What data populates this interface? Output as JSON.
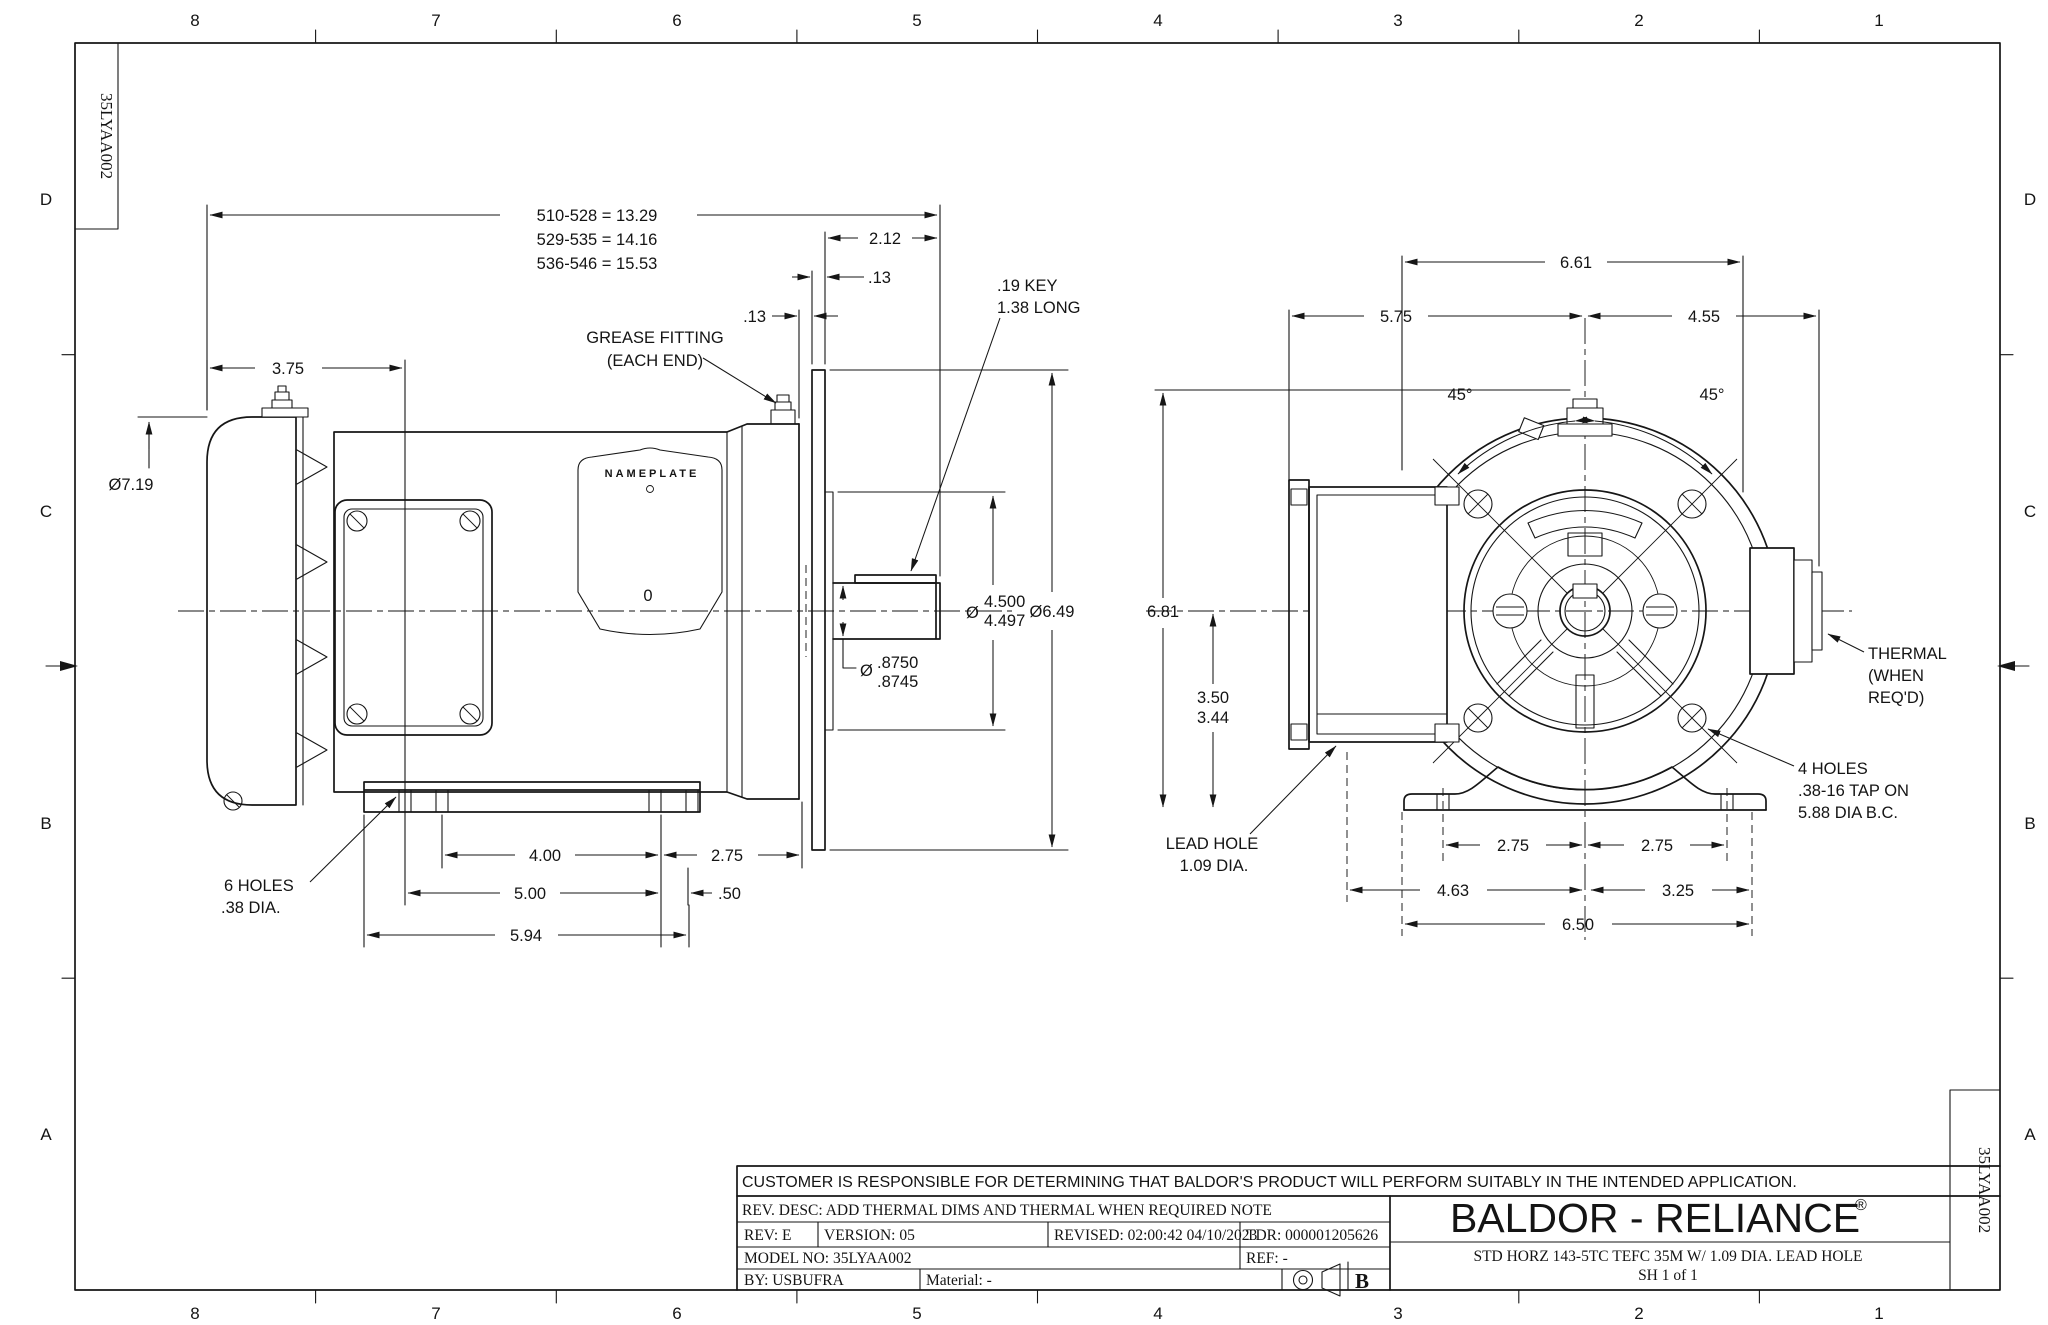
{
  "sheet": {
    "doc_number": "35LYAA002",
    "zone_cols": [
      "8",
      "7",
      "6",
      "5",
      "4",
      "3",
      "2",
      "1"
    ],
    "zone_rows": [
      "D",
      "C",
      "B",
      "A"
    ]
  },
  "side_view": {
    "overall_len_1": "510-528 = 13.29",
    "overall_len_2": "529-535 = 14.16",
    "overall_len_3": "536-546 = 15.53",
    "shaft_ext": "2.12",
    "gap_a": ".13",
    "gap_b": ".13",
    "fan_to_hole": "3.75",
    "fan_od": "Ø7.19",
    "grease_note_1": "GREASE FITTING",
    "grease_note_2": "(EACH END)",
    "key_note_1": ".19 KEY",
    "key_note_2": "1.38 LONG",
    "nameplate": "NAMEPLATE",
    "nameplate_zero": "0",
    "rabbet_phi": "Ø",
    "rabbet_hi": "4.500",
    "rabbet_lo": "4.497",
    "flange_od": "Ø6.49",
    "shaft_phi": "Ø",
    "shaft_hi": ".8750",
    "shaft_lo": ".8745",
    "holes_note_1": "6 HOLES",
    "holes_note_2": ".38 DIA.",
    "foot_span": "4.00",
    "foot_to_face": "2.75",
    "foot_span2": "5.00",
    "edge_off": ".50",
    "base_len": "5.94"
  },
  "end_view": {
    "width_top": "6.61",
    "left_half": "5.75",
    "right_half": "4.55",
    "angle_left": "45°",
    "angle_right": "45°",
    "height_overall": "6.81",
    "ctr_height_hi": "3.50",
    "ctr_height_lo": "3.44",
    "lead_note_1": "LEAD HOLE",
    "lead_note_2": "1.09 DIA.",
    "thermal_note_1": "THERMAL",
    "thermal_note_2": "(WHEN",
    "thermal_note_3": "REQ'D)",
    "tap_note_1": "4 HOLES",
    "tap_note_2": ".38-16 TAP ON",
    "tap_note_3": "5.88 DIA B.C.",
    "foot_l": "2.75",
    "foot_r": "2.75",
    "base_l": "4.63",
    "base_r": "3.25",
    "base_w": "6.50"
  },
  "title_block": {
    "disclaimer": "CUSTOMER IS RESPONSIBLE FOR DETERMINING THAT BALDOR'S PRODUCT WILL PERFORM SUITABLY IN THE INTENDED APPLICATION.",
    "rev_desc": "REV. DESC: ADD THERMAL DIMS AND THERMAL WHEN REQUIRED NOTE",
    "rev": "REV: E",
    "version": "VERSION: 05",
    "revised": "REVISED: 02:00:42 04/10/2023",
    "tdr": "TDR: 000001205626",
    "model_no": "MODEL NO: 35LYAA002",
    "ref": "REF: -",
    "by": "BY: USBUFRA",
    "material": "Material: -",
    "size_letter": "B",
    "brand": "BALDOR - RELIANCE",
    "brand_reg": "®",
    "title_line1": "STD HORZ 143-5TC TEFC 35M W/ 1.09 DIA. LEAD HOLE",
    "title_line2": "SH 1 of 1"
  }
}
